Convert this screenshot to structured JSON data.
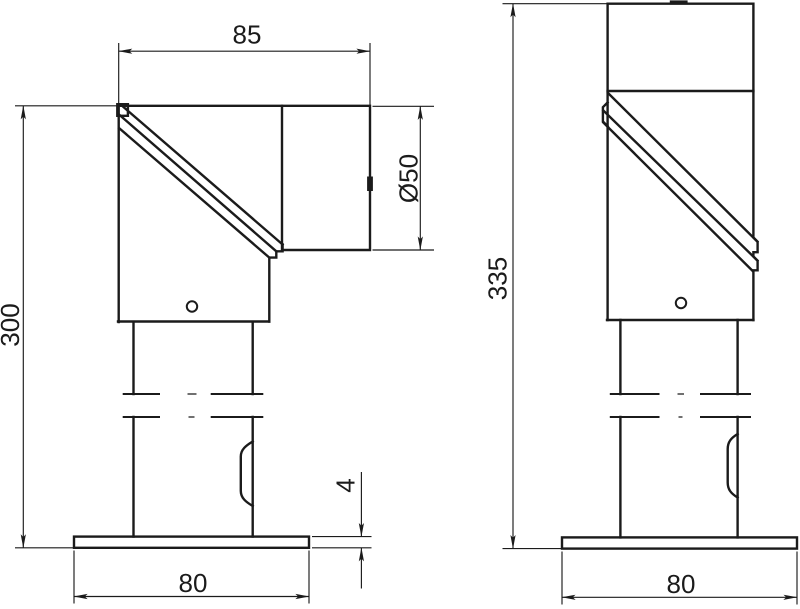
{
  "drawing": {
    "background": "#ffffff",
    "line_color": "#1b1b1b",
    "front_view": {
      "dimensions": {
        "top_width": "85",
        "outlet_diameter": "Ø50",
        "overall_height": "300",
        "plate_thickness": "4",
        "base_width": "80"
      }
    },
    "side_view": {
      "dimensions": {
        "overall_height": "335",
        "base_width": "80"
      }
    }
  }
}
